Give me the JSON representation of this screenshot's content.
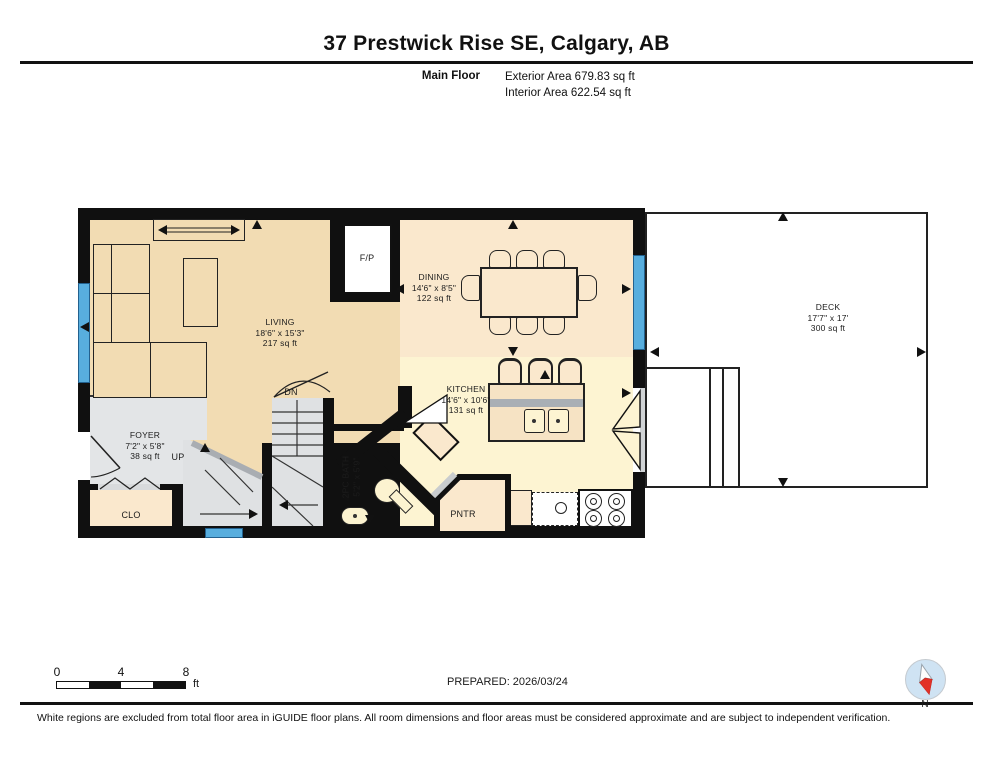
{
  "header": {
    "title": "37 Prestwick Rise SE, Calgary, AB",
    "floor_label": "Main Floor",
    "exterior_area": "Exterior Area 679.83 sq ft",
    "interior_area": "Interior Area 622.54 sq ft"
  },
  "rooms": {
    "living": {
      "name": "LIVING",
      "dims": "18'6\" x 15'3\"",
      "area": "217 sq ft"
    },
    "dining": {
      "name": "DINING",
      "dims": "14'6\" x 8'5\"",
      "area": "122 sq ft"
    },
    "kitchen": {
      "name": "KITCHEN",
      "dims": "14'6\" x 10'6\"",
      "area": "131 sq ft"
    },
    "foyer": {
      "name": "FOYER",
      "dims": "7'2\" x 5'8\"",
      "area": "38 sq ft"
    },
    "deck": {
      "name": "DECK",
      "dims": "17'7\" x 17'",
      "area": "300 sq ft"
    },
    "bath": {
      "name": "2PC BATH",
      "dims": "5'2\" x 5'9\""
    },
    "closet": {
      "name": "CLO"
    },
    "pantry": {
      "name": "PNTR"
    },
    "fireplace": {
      "name": "F/P"
    },
    "stairs_up": {
      "name": "UP"
    },
    "stairs_down": {
      "name": "DN"
    }
  },
  "footer": {
    "scale": {
      "ticks": [
        "0",
        "4",
        "8"
      ],
      "unit": "ft"
    },
    "prepared": "PREPARED: 2026/03/24",
    "compass_label": "N",
    "disclaimer": "White regions are excluded from total floor area in iGUIDE floor plans. All room dimensions and floor areas must be considered approximate and are subject to independent verification."
  },
  "colors": {
    "wall": "#101010",
    "living_floor": "#f2dcb3",
    "dining_floor": "#fae8cd",
    "kitchen_floor": "#fdf4d2",
    "foyer_floor": "#e3e5e7",
    "stair_floor": "#dfe1e3",
    "window": "#58aede",
    "counter_band": "#a9afb5",
    "compass_red": "#e23128",
    "compass_circle": "#cfe3f3"
  }
}
